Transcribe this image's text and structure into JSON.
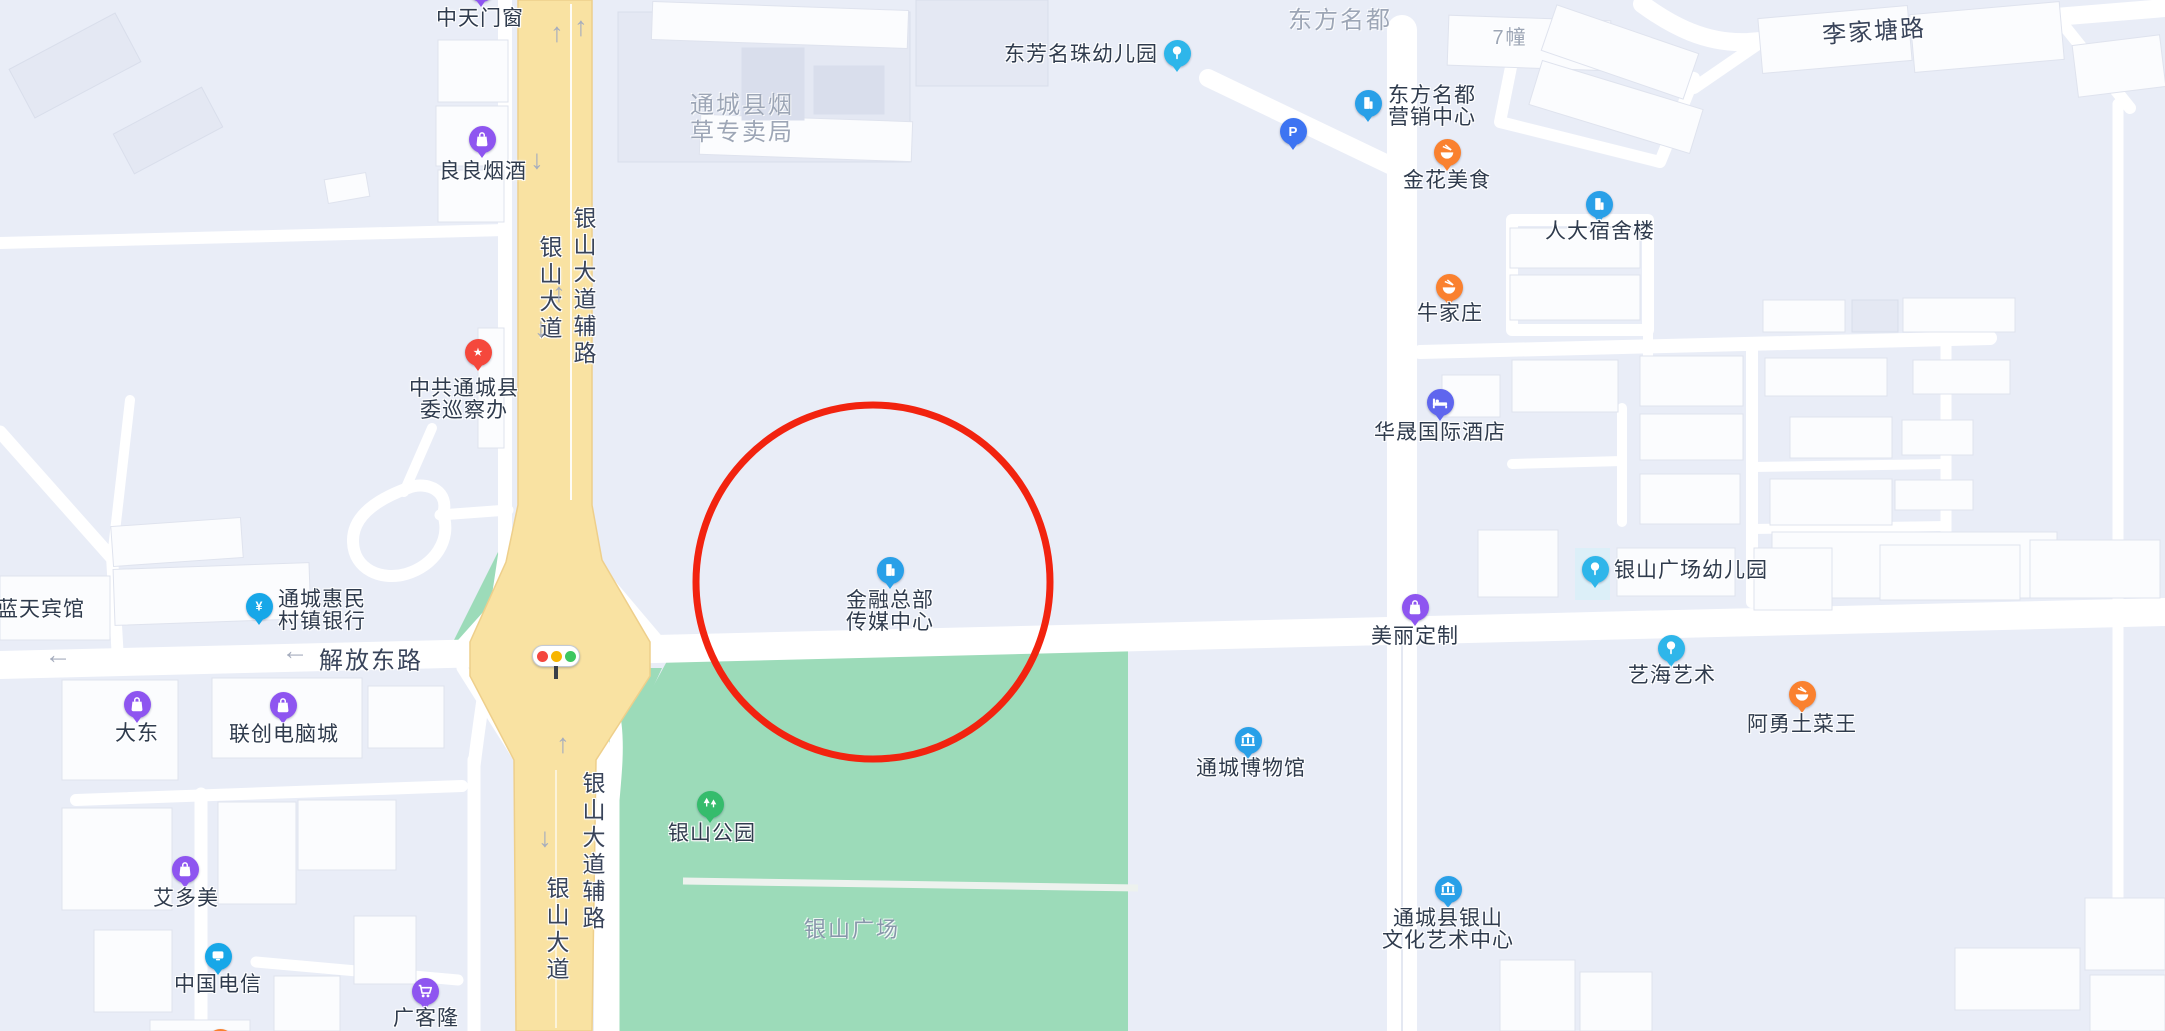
{
  "map": {
    "colors": {
      "background": "#E9EDF7",
      "road": "#FFFFFF",
      "main_road": "#F9E2A2",
      "main_road_edge": "#EECF8B",
      "park": "#9CDBB9",
      "park_path": "#EDF2EE",
      "poi_text": "#2F3B4D",
      "road_text": "#39445A",
      "area_text": "#9DA6B6",
      "plaza_text": "#8897AB",
      "arrow": "#A6ADBE",
      "annotation_red": "#F2230F"
    },
    "annotation_circle": {
      "cx": 873,
      "cy": 582,
      "r": 177,
      "stroke_width": 7
    },
    "traffic_light": {
      "x": 555,
      "y": 655,
      "light_colors": [
        "#F4463E",
        "#F7B500",
        "#3DC760"
      ]
    },
    "road_labels": [
      {
        "text": "银山大道",
        "x": 549,
        "y": 289,
        "vertical": true
      },
      {
        "text": "银山大道辅路",
        "x": 583,
        "y": 287,
        "vertical": true
      },
      {
        "text": "解放东路",
        "x": 371,
        "y": 658,
        "vertical": false
      },
      {
        "text": "银山大道辅路",
        "x": 592,
        "y": 852,
        "vertical": true
      },
      {
        "text": "银山大道",
        "x": 556,
        "y": 930,
        "vertical": true
      },
      {
        "text": "李家塘路",
        "x": 1874,
        "y": 29,
        "vertical": false,
        "rotate": -4
      }
    ],
    "area_labels": [
      {
        "lines": [
          "通城县烟",
          "草专卖局"
        ],
        "x": 742,
        "y": 92,
        "size": 24,
        "color": "#9DA6B6"
      },
      {
        "lines": [
          "东方名都"
        ],
        "x": 1340,
        "y": 7,
        "size": 24,
        "color": "#9DA6B6"
      },
      {
        "lines": [
          "7幢"
        ],
        "x": 1510,
        "y": 27,
        "size": 20,
        "color": "#9DA6B6"
      },
      {
        "lines": [
          "银山广场"
        ],
        "x": 852,
        "y": 917,
        "size": 22,
        "color": "#8897AB"
      }
    ],
    "arrows": [
      {
        "x": 557,
        "y": 33,
        "dir": "up"
      },
      {
        "x": 581,
        "y": 27,
        "dir": "up"
      },
      {
        "x": 537,
        "y": 160,
        "dir": "down"
      },
      {
        "x": 559,
        "y": 293,
        "dir": "up"
      },
      {
        "x": 541,
        "y": 328,
        "dir": "down"
      },
      {
        "x": 563,
        "y": 744,
        "dir": "up"
      },
      {
        "x": 545,
        "y": 838,
        "dir": "down"
      },
      {
        "x": 58,
        "y": 655,
        "dir": "left"
      },
      {
        "x": 295,
        "y": 651,
        "dir": "left"
      }
    ],
    "pois": [
      {
        "id": "zhongtian-doors-windows",
        "lines": [
          "中天门窗"
        ],
        "icon": "shopping-bag-icon",
        "color": "#8E55F0",
        "x": 481,
        "y": -12,
        "label_x": 480,
        "label_y": 8,
        "align": "center"
      },
      {
        "id": "liangliang-tobacco-liquor",
        "lines": [
          "良良烟酒"
        ],
        "icon": "shopping-bag-icon",
        "color": "#8E55F0",
        "x": 482,
        "y": 139,
        "label_x": 483,
        "label_y": 161,
        "align": "center"
      },
      {
        "id": "dongfang-mingzhu-kindergarten",
        "lines": [
          "东芳名珠幼儿园"
        ],
        "icon": "signpost-icon",
        "color": "#2EB6EA",
        "x": 1177,
        "y": 53,
        "label_x": 1158,
        "label_y": 44,
        "align": "right"
      },
      {
        "id": "dongfangmingdu-sales-center",
        "lines": [
          "东方名都",
          "营销中心"
        ],
        "icon": "building-icon",
        "color": "#29A0E8",
        "x": 1368,
        "y": 103,
        "label_x": 1388,
        "label_y": 85,
        "align": "left"
      },
      {
        "id": "parking",
        "lines": [],
        "icon": "parking-icon",
        "color": "#3D74F2",
        "x": 1293,
        "y": 131,
        "label_x": 0,
        "label_y": 0,
        "align": "center"
      },
      {
        "id": "jinhua-food",
        "lines": [
          "金花美食"
        ],
        "icon": "food-bowl-icon",
        "color": "#FA812F",
        "x": 1447,
        "y": 152,
        "label_x": 1447,
        "label_y": 170,
        "align": "center"
      },
      {
        "id": "renda-dormitory",
        "lines": [
          "人大宿舍楼"
        ],
        "icon": "building-icon",
        "color": "#29A0E8",
        "x": 1599,
        "y": 204,
        "label_x": 1600,
        "label_y": 221,
        "align": "center"
      },
      {
        "id": "niujiazhuang",
        "lines": [
          "牛家庄"
        ],
        "icon": "food-bowl-icon",
        "color": "#FA812F",
        "x": 1449,
        "y": 287,
        "label_x": 1450,
        "label_y": 303,
        "align": "center"
      },
      {
        "id": "huasheng-intl-hotel",
        "lines": [
          "华晟国际酒店"
        ],
        "icon": "bed-icon",
        "color": "#5F66EE",
        "x": 1440,
        "y": 402,
        "label_x": 1440,
        "label_y": 422,
        "align": "center"
      },
      {
        "id": "xunchaban",
        "lines": [
          "中共通城县",
          "委巡察办"
        ],
        "icon": "star-icon",
        "color": "#F5483C",
        "x": 478,
        "y": 352,
        "label_x": 464,
        "label_y": 378,
        "align": "center"
      },
      {
        "id": "lantian-hotel",
        "lines": [
          "蓝天宾馆"
        ],
        "icon": null,
        "color": null,
        "x": 41,
        "y": 610,
        "label_x": 41,
        "label_y": 599,
        "align": "center"
      },
      {
        "id": "huimin-bank",
        "lines": [
          "通城惠民",
          "村镇银行"
        ],
        "icon": "yuan-icon",
        "color": "#17A7E8",
        "x": 259,
        "y": 606,
        "label_x": 278,
        "label_y": 589,
        "align": "left"
      },
      {
        "id": "jinrong-media-center",
        "lines": [
          "金融总部",
          "传媒中心"
        ],
        "icon": "building-icon",
        "color": "#29A0E8",
        "x": 890,
        "y": 570,
        "label_x": 890,
        "label_y": 590,
        "align": "center"
      },
      {
        "id": "meili-dingzhi",
        "lines": [
          "美丽定制"
        ],
        "icon": "shopping-bag-icon",
        "color": "#8E55F0",
        "x": 1415,
        "y": 607,
        "label_x": 1415,
        "label_y": 626,
        "align": "center"
      },
      {
        "id": "yinshan-plaza-kindergarten",
        "lines": [
          "银山广场幼儿园"
        ],
        "icon": "signpost-icon",
        "color": "#2EB6EA",
        "x": 1595,
        "y": 569,
        "label_x": 1614,
        "label_y": 560,
        "align": "left"
      },
      {
        "id": "yihai-art",
        "lines": [
          "艺海艺术"
        ],
        "icon": "signpost-icon",
        "color": "#2EB6EA",
        "x": 1671,
        "y": 648,
        "label_x": 1672,
        "label_y": 665,
        "align": "center"
      },
      {
        "id": "ayong-local-dishes",
        "lines": [
          "阿勇土菜王"
        ],
        "icon": "food-bowl-icon",
        "color": "#FA812F",
        "x": 1802,
        "y": 694,
        "label_x": 1802,
        "label_y": 714,
        "align": "center"
      },
      {
        "id": "dadong",
        "lines": [
          "大东"
        ],
        "icon": "shopping-bag-icon",
        "color": "#8E55F0",
        "x": 137,
        "y": 704,
        "label_x": 137,
        "label_y": 723,
        "align": "center"
      },
      {
        "id": "lianchuang-computer-city",
        "lines": [
          "联创电脑城"
        ],
        "icon": "shopping-bag-icon",
        "color": "#8E55F0",
        "x": 283,
        "y": 705,
        "label_x": 284,
        "label_y": 724,
        "align": "center"
      },
      {
        "id": "tongcheng-museum",
        "lines": [
          "通城博物馆"
        ],
        "icon": "museum-icon",
        "color": "#29A0E8",
        "x": 1248,
        "y": 740,
        "label_x": 1251,
        "label_y": 758,
        "align": "center"
      },
      {
        "id": "aiduomei",
        "lines": [
          "艾多美"
        ],
        "icon": "shopping-bag-icon",
        "color": "#8E55F0",
        "x": 185,
        "y": 869,
        "label_x": 186,
        "label_y": 888,
        "align": "center"
      },
      {
        "id": "china-telecom",
        "lines": [
          "中国电信"
        ],
        "icon": "telecom-icon",
        "color": "#17A7E8",
        "x": 218,
        "y": 956,
        "label_x": 218,
        "label_y": 974,
        "align": "center"
      },
      {
        "id": "guangkelong",
        "lines": [
          "广客隆"
        ],
        "icon": "cart-icon",
        "color": "#8E55F0",
        "x": 425,
        "y": 991,
        "label_x": 426,
        "label_y": 1008,
        "align": "center"
      },
      {
        "id": "yinshan-culture-art-center",
        "lines": [
          "通城县银山",
          "文化艺术中心"
        ],
        "icon": "museum-icon",
        "color": "#29A0E8",
        "x": 1448,
        "y": 889,
        "label_x": 1448,
        "label_y": 908,
        "align": "center"
      },
      {
        "id": "yinshan-park",
        "lines": [
          "银山公园"
        ],
        "icon": "trees-icon",
        "color": "#35BC6C",
        "x": 710,
        "y": 804,
        "label_x": 712,
        "label_y": 823,
        "align": "center"
      },
      {
        "id": "edge-poi-bottom",
        "lines": [],
        "icon": "food-bowl-icon",
        "color": "#FA812F",
        "x": 220,
        "y": 1042,
        "label_x": 0,
        "label_y": 0,
        "align": "center"
      }
    ]
  }
}
